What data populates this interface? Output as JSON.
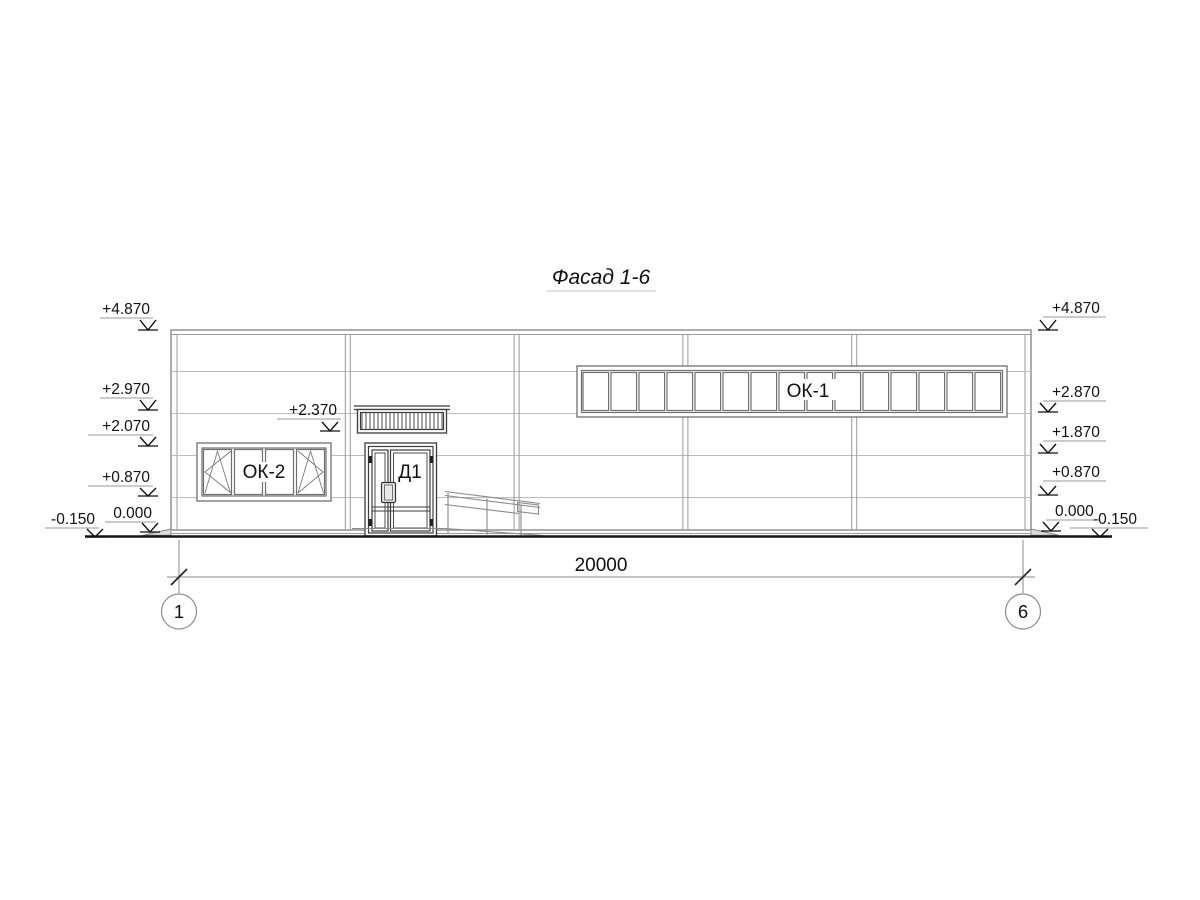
{
  "title": "Фасад 1-6",
  "marks": {
    "left": [
      "+4.870",
      "+2.970",
      "+2.070",
      "+0.870",
      "0.000",
      "-0.150"
    ],
    "right": [
      "+4.870",
      "+2.870",
      "+1.870",
      "+0.870",
      "0.000",
      "-0.150"
    ],
    "door_head": "+2.370"
  },
  "labels": {
    "window_strip": "ОК-1",
    "window_left": "ОК-2",
    "door": "Д1"
  },
  "dimension": {
    "total": "20000"
  },
  "axes": {
    "start": "1",
    "end": "6"
  },
  "colors": {
    "ink": "#111111",
    "wall_line": "#8a8a8a",
    "joint_line": "#bcbcbc",
    "background": "#ffffff"
  }
}
